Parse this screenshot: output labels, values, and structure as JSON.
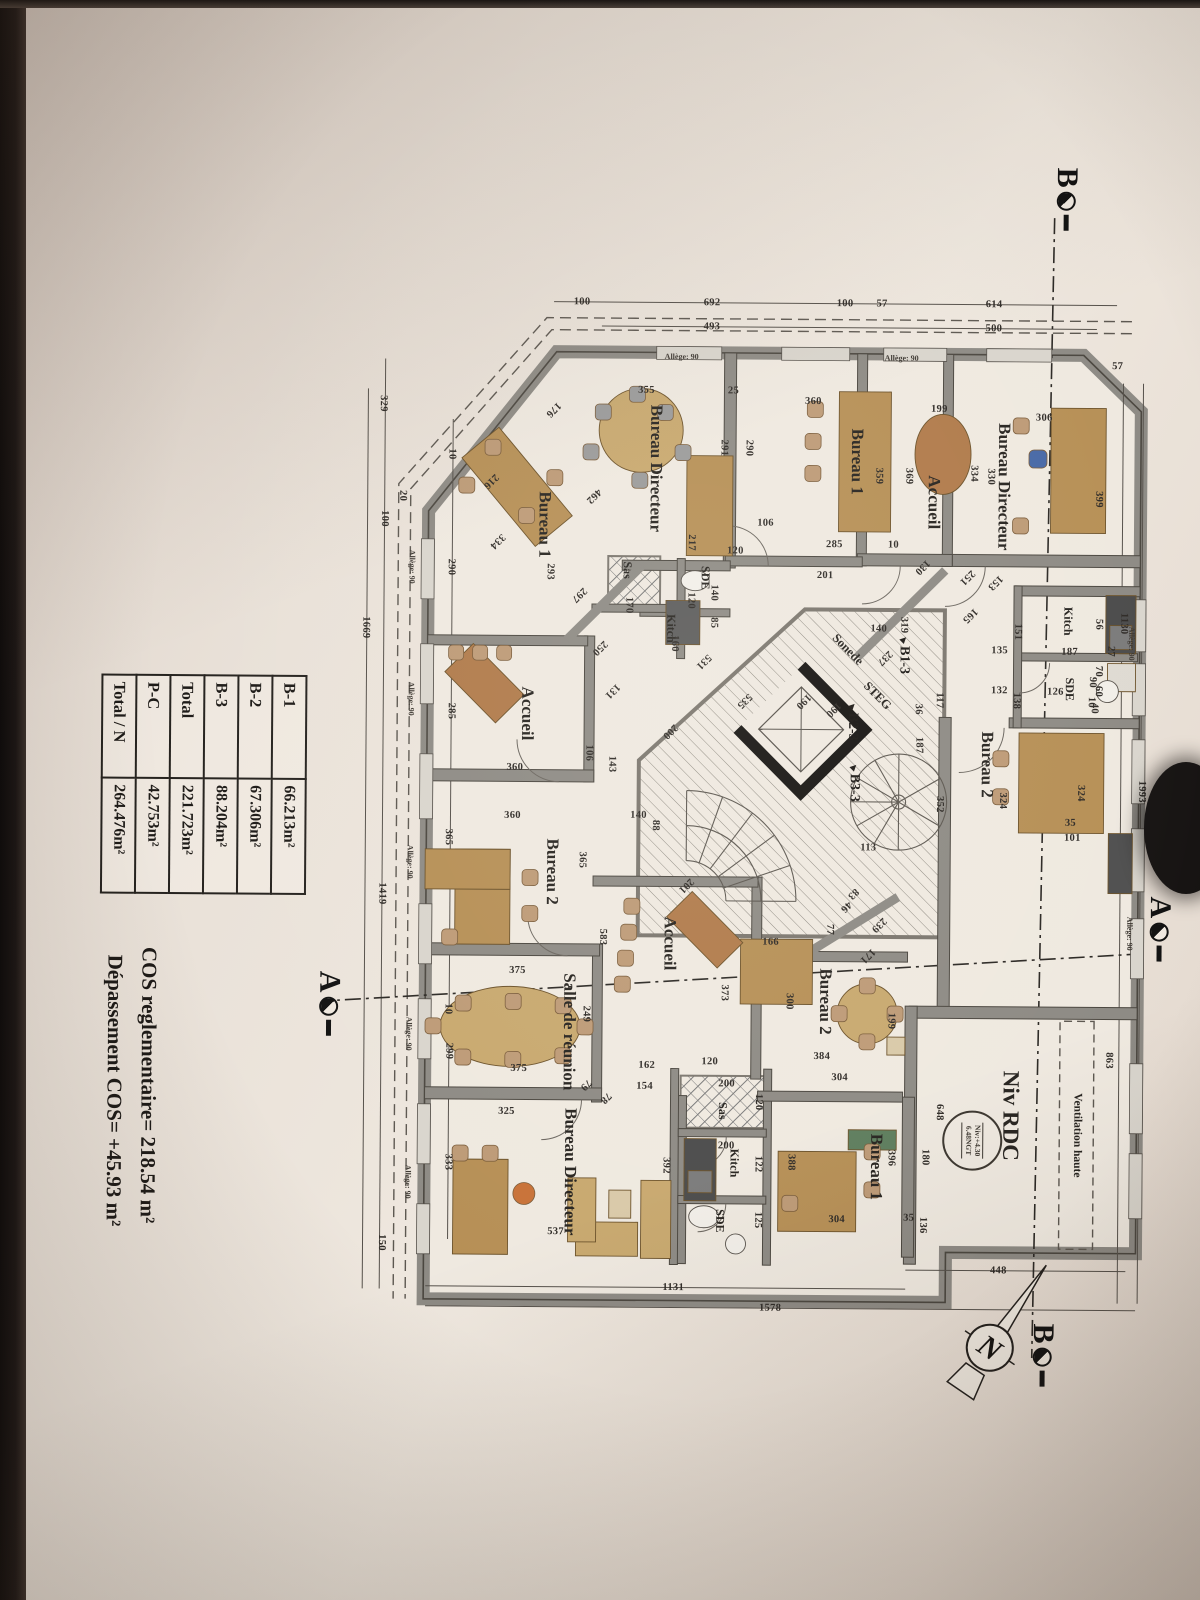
{
  "table": {
    "rows": [
      {
        "label": "B-1",
        "value": "66.213m²"
      },
      {
        "label": "B-2",
        "value": "67.306m²"
      },
      {
        "label": "B-3",
        "value": "88.204m²"
      },
      {
        "label": "Total",
        "value": "221.723m²"
      },
      {
        "label": "P-C",
        "value": "42.753m²"
      },
      {
        "label": "Total / N",
        "value": "264.476m²"
      }
    ]
  },
  "notes": {
    "line1": "COS reglementaire= 218.54 m²",
    "line2": "Dépassement COS= +45.93 m²"
  },
  "title": {
    "level_label": "Niv RDC"
  },
  "stamp": {
    "line1": "Niv:+4.30",
    "line2": "6.48NGT"
  },
  "ventilation_label": "Ventilation haute",
  "allege_label": "Allège: 90",
  "north_letter": "N",
  "section_markers": [
    {
      "letter": "A",
      "x": 925,
      "y": 38
    },
    {
      "letter": "A",
      "x": 1005,
      "y": 868
    },
    {
      "letter": "B",
      "x": 196,
      "y": 136
    },
    {
      "letter": "B",
      "x": 1352,
      "y": 152
    }
  ],
  "utilities": [
    {
      "label": "Sonede",
      "x": 648,
      "y": 352
    },
    {
      "label": "STEG",
      "x": 694,
      "y": 322
    }
  ],
  "entries": [
    {
      "label": "B1-3",
      "x": 652,
      "y": 296
    },
    {
      "label": "B2-3",
      "x": 719,
      "y": 347
    },
    {
      "label": "B3-3",
      "x": 780,
      "y": 345
    }
  ],
  "rooms": [
    {
      "label": "Bureau Directeur",
      "x": 468,
      "y": 545,
      "s": 17
    },
    {
      "label": "Bureau 1",
      "x": 525,
      "y": 656,
      "s": 17
    },
    {
      "label": "Sas",
      "x": 570,
      "y": 573,
      "s": 12
    },
    {
      "label": "SDE",
      "x": 577,
      "y": 495,
      "s": 12
    },
    {
      "label": "Kitch",
      "x": 628,
      "y": 529,
      "s": 12
    },
    {
      "label": "Accueil",
      "x": 714,
      "y": 672,
      "s": 17
    },
    {
      "label": "Bureau Directeur",
      "x": 484,
      "y": 197,
      "s": 17
    },
    {
      "label": "Accueil",
      "x": 500,
      "y": 267,
      "s": 17
    },
    {
      "label": "Bureau 1",
      "x": 460,
      "y": 344,
      "s": 17
    },
    {
      "label": "Kitch",
      "x": 618,
      "y": 132,
      "s": 12
    },
    {
      "label": "SDE",
      "x": 686,
      "y": 130,
      "s": 12
    },
    {
      "label": "Bureau 2",
      "x": 762,
      "y": 212,
      "s": 17
    },
    {
      "label": "Bureau 1",
      "x": 1165,
      "y": 320,
      "s": 17
    },
    {
      "label": "Bureau 2",
      "x": 1000,
      "y": 372,
      "s": 17
    },
    {
      "label": "Accueil",
      "x": 943,
      "y": 528,
      "s": 17
    },
    {
      "label": "Sas",
      "x": 1110,
      "y": 474,
      "s": 12
    },
    {
      "label": "Kitch",
      "x": 1162,
      "y": 462,
      "s": 12
    },
    {
      "label": "SDE",
      "x": 1220,
      "y": 476,
      "s": 12
    },
    {
      "label": "Salle de réunion",
      "x": 1032,
      "y": 628,
      "s": 17
    },
    {
      "label": "Bureau 2",
      "x": 872,
      "y": 646,
      "s": 17
    },
    {
      "label": "Bureau Directeur",
      "x": 1172,
      "y": 626,
      "s": 17
    }
  ],
  "dims": [
    [
      "1130",
      620,
      76,
      0
    ],
    [
      "863",
      1057,
      88,
      0
    ],
    [
      "1993",
      788,
      57,
      0
    ],
    [
      "57",
      363,
      84,
      -90
    ],
    [
      "614",
      302,
      208,
      -90
    ],
    [
      "57",
      302,
      320,
      -90
    ],
    [
      "100",
      302,
      357,
      -90
    ],
    [
      "692",
      302,
      490,
      -90
    ],
    [
      "100",
      302,
      620,
      -90
    ],
    [
      "500",
      326,
      208,
      -90
    ],
    [
      "493",
      326,
      490,
      -90
    ],
    [
      "329",
      405,
      818,
      0
    ],
    [
      "100",
      520,
      816,
      0
    ],
    [
      "20",
      497,
      798,
      0
    ],
    [
      "1419",
      895,
      816,
      0
    ],
    [
      "150",
      1244,
      814,
      0
    ],
    [
      "1669",
      629,
      834,
      0
    ],
    [
      "290",
      568,
      749,
      0
    ],
    [
      "285",
      712,
      748,
      0
    ],
    [
      "365",
      838,
      750,
      0
    ],
    [
      "299",
      1052,
      748,
      0
    ],
    [
      "333",
      1163,
      748,
      0
    ],
    [
      "10",
      455,
      749,
      0
    ],
    [
      "10",
      1010,
      749,
      0
    ],
    [
      "448",
      1268,
      197,
      -90
    ],
    [
      "1131",
      1287,
      522,
      -90
    ],
    [
      "1578",
      1307,
      425,
      -90
    ],
    [
      "101",
      835,
      126,
      -90
    ],
    [
      "35",
      820,
      128,
      -90
    ],
    [
      "90",
      679,
      107,
      0
    ],
    [
      "10",
      699,
      108,
      0
    ],
    [
      "324",
      790,
      118,
      0
    ],
    [
      "324",
      798,
      196,
      0
    ],
    [
      "352",
      802,
      259,
      0
    ],
    [
      "319",
      623,
      296,
      0
    ],
    [
      "117",
      698,
      260,
      0
    ],
    [
      "187",
      743,
      280,
      0
    ],
    [
      "36",
      707,
      281,
      0
    ],
    [
      "136",
      1223,
      273,
      0
    ],
    [
      "180",
      1155,
      271,
      0
    ],
    [
      "648",
      1110,
      257,
      0
    ],
    [
      "396",
      1156,
      305,
      0
    ],
    [
      "388",
      1161,
      405,
      0
    ],
    [
      "392",
      1165,
      530,
      0
    ],
    [
      "304",
      1218,
      359,
      -90
    ],
    [
      "35",
      1216,
      287,
      -90
    ],
    [
      "384",
      1055,
      375,
      -90
    ],
    [
      "304",
      1076,
      357,
      -90
    ],
    [
      "162",
      1065,
      550,
      -90
    ],
    [
      "120",
      1061,
      487,
      -90
    ],
    [
      "154",
      1086,
      552,
      -90
    ],
    [
      "200",
      1083,
      470,
      -90
    ],
    [
      "120",
      1101,
      438,
      0
    ],
    [
      "200",
      1145,
      470,
      -90
    ],
    [
      "122",
      1163,
      438,
      0
    ],
    [
      "125",
      1219,
      438,
      0
    ],
    [
      "166",
      941,
      427,
      -90
    ],
    [
      "373",
      992,
      473,
      0
    ],
    [
      "300",
      1000,
      408,
      0
    ],
    [
      "199",
      1019,
      306,
      0
    ],
    [
      "171",
      954,
      330,
      45
    ],
    [
      "239",
      923,
      319,
      45
    ],
    [
      "83",
      892,
      345,
      45
    ],
    [
      "113",
      846,
      330,
      -90
    ],
    [
      "77",
      928,
      368,
      0
    ],
    [
      "46",
      905,
      352,
      45
    ],
    [
      "531",
      661,
      496,
      45
    ],
    [
      "535",
      700,
      455,
      45
    ],
    [
      "250",
      648,
      600,
      45
    ],
    [
      "131",
      691,
      587,
      45
    ],
    [
      "143",
      764,
      587,
      0
    ],
    [
      "88",
      825,
      543,
      0
    ],
    [
      "140",
      815,
      560,
      -90
    ],
    [
      "140",
      592,
      486,
      0
    ],
    [
      "85",
      622,
      486,
      0
    ],
    [
      "160",
      643,
      525,
      0
    ],
    [
      "170",
      605,
      571,
      0
    ],
    [
      "120",
      600,
      509,
      0
    ],
    [
      "120",
      550,
      465,
      -90
    ],
    [
      "201",
      574,
      375,
      -90
    ],
    [
      "285",
      543,
      366,
      -90
    ],
    [
      "10",
      543,
      307,
      -90
    ],
    [
      "130",
      565,
      278,
      45
    ],
    [
      "153",
      580,
      205,
      45
    ],
    [
      "251",
      575,
      233,
      45
    ],
    [
      "165",
      613,
      230,
      45
    ],
    [
      "237",
      656,
      315,
      45
    ],
    [
      "140",
      627,
      321,
      -90
    ],
    [
      "190",
      700,
      396,
      45
    ],
    [
      "190",
      708,
      366,
      45
    ],
    [
      "200",
      731,
      529,
      45
    ],
    [
      "355",
      390,
      555,
      -90
    ],
    [
      "25",
      390,
      468,
      -90
    ],
    [
      "176",
      410,
      648,
      45
    ],
    [
      "462",
      496,
      607,
      45
    ],
    [
      "291",
      447,
      477,
      0
    ],
    [
      "290",
      447,
      452,
      0
    ],
    [
      "106",
      522,
      435,
      -90
    ],
    [
      "217",
      542,
      509,
      0
    ],
    [
      "293",
      572,
      650,
      0
    ],
    [
      "297",
      595,
      621,
      45
    ],
    [
      "216",
      482,
      710,
      45
    ],
    [
      "334",
      542,
      703,
      45
    ],
    [
      "360",
      400,
      388,
      -90
    ],
    [
      "199",
      407,
      262,
      -90
    ],
    [
      "359",
      474,
      322,
      0
    ],
    [
      "369",
      474,
      292,
      0
    ],
    [
      "334",
      471,
      227,
      0
    ],
    [
      "330",
      474,
      210,
      0
    ],
    [
      "306",
      415,
      157,
      -90
    ],
    [
      "399",
      496,
      102,
      0
    ],
    [
      "106",
      753,
      610,
      0
    ],
    [
      "360",
      768,
      684,
      -90
    ],
    [
      "360",
      816,
      686,
      -90
    ],
    [
      "365",
      860,
      616,
      0
    ],
    [
      "583",
      937,
      595,
      0
    ],
    [
      "375",
      971,
      680,
      -90
    ],
    [
      "375",
      1069,
      678,
      -90
    ],
    [
      "325",
      1112,
      690,
      -90
    ],
    [
      "249",
      1014,
      611,
      0
    ],
    [
      "79",
      1085,
      611,
      45
    ],
    [
      "78",
      1098,
      591,
      45
    ],
    [
      "537",
      1232,
      640,
      -90
    ],
    [
      "201",
      885,
      512,
      45
    ],
    [
      "151",
      629,
      182,
      0
    ],
    [
      "135",
      648,
      200,
      -90
    ],
    [
      "187",
      649,
      130,
      -90
    ],
    [
      "132",
      688,
      200,
      -90
    ],
    [
      "126",
      689,
      144,
      -90
    ],
    [
      "138",
      698,
      183,
      0
    ],
    [
      "56",
      621,
      101,
      0
    ],
    [
      "27",
      648,
      89,
      0
    ],
    [
      "70",
      668,
      101,
      0
    ],
    [
      "60",
      688,
      101,
      0
    ],
    [
      "40",
      705,
      105,
      0
    ]
  ],
  "alleges": [
    [
      568,
      788,
      0
    ],
    [
      700,
      788,
      0
    ],
    [
      863,
      788,
      0
    ],
    [
      1035,
      788,
      0
    ],
    [
      1183,
      788,
      0
    ],
    [
      356,
      300,
      -90
    ],
    [
      356,
      520,
      -90
    ],
    [
      640,
      68,
      0
    ],
    [
      930,
      68,
      0
    ]
  ]
}
